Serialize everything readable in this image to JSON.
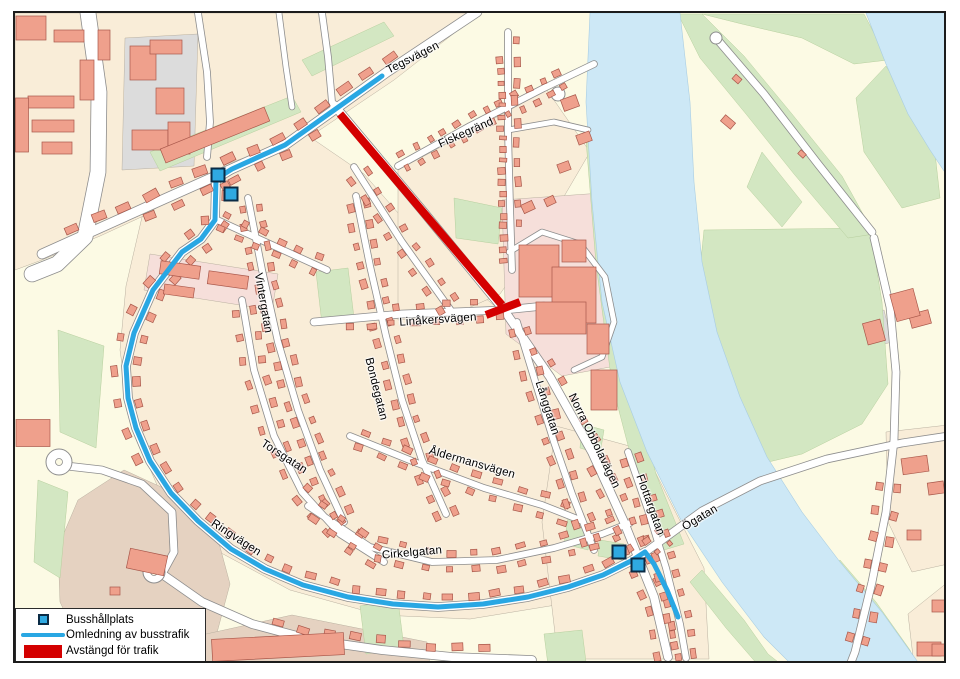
{
  "colors": {
    "route_blue": "#29A7E3",
    "closed_red": "#D40000",
    "bus_stop_fill": "#2FA9E1",
    "bus_stop_border": "#0A2B45",
    "water": "#CDE8F6",
    "green": "#D3E7C2",
    "building": "#EFA08C",
    "road": "#FFFFFF"
  },
  "legend": {
    "items": [
      {
        "id": "bus-stop",
        "symbol": "square",
        "label": "Busshållplats"
      },
      {
        "id": "detour",
        "symbol": "line",
        "label": "Omledning av busstrafik"
      },
      {
        "id": "closed",
        "symbol": "rect",
        "label": "Avstängd för trafik"
      }
    ]
  },
  "map": {
    "street_labels": [
      {
        "id": "tegsvagen",
        "text": "Tegsvägen",
        "x": 411,
        "y": 56,
        "rot": -27
      },
      {
        "id": "fiskegrand",
        "text": "Fiskegränd",
        "x": 464,
        "y": 131,
        "rot": -24
      },
      {
        "id": "vintergatan",
        "text": "Vintergatan",
        "x": 261,
        "y": 301,
        "rot": 80
      },
      {
        "id": "linakersvagen",
        "text": "Linåkersvägen",
        "x": 436,
        "y": 318,
        "rot": -4
      },
      {
        "id": "bondegatan",
        "text": "Bondegatan",
        "x": 374,
        "y": 387,
        "rot": 76
      },
      {
        "id": "torsgatan",
        "text": "Torsgatan",
        "x": 282,
        "y": 455,
        "rot": 33
      },
      {
        "id": "aldermansvagen",
        "text": "Åldermansvägen",
        "x": 470,
        "y": 461,
        "rot": 16
      },
      {
        "id": "cirkelgatan",
        "text": "Cirkelgatan",
        "x": 410,
        "y": 551,
        "rot": -5
      },
      {
        "id": "ringvagen",
        "text": "Ringvägen",
        "x": 234,
        "y": 536,
        "rot": 33
      },
      {
        "id": "langgatan",
        "text": "Långgatan",
        "x": 545,
        "y": 406,
        "rot": 72
      },
      {
        "id": "norra-obbolavagen",
        "text": "Norra Obbolavägen",
        "x": 592,
        "y": 439,
        "rot": 64
      },
      {
        "id": "flottargatan",
        "text": "Flottargatan",
        "x": 648,
        "y": 503,
        "rot": 70
      },
      {
        "id": "ogatan",
        "text": "Ögatan",
        "x": 698,
        "y": 516,
        "rot": -31
      }
    ],
    "bus_stops": [
      {
        "x": 216,
        "y": 173
      },
      {
        "x": 229,
        "y": 192
      },
      {
        "x": 617,
        "y": 550
      },
      {
        "x": 636,
        "y": 563
      }
    ],
    "detour_route": {
      "points": [
        [
          380,
          74
        ],
        [
          283,
          143
        ],
        [
          230,
          167
        ],
        [
          214,
          177
        ],
        [
          213,
          218
        ],
        [
          199,
          237
        ],
        [
          180,
          250
        ],
        [
          151,
          288
        ],
        [
          132,
          331
        ],
        [
          124,
          364
        ],
        [
          126,
          396
        ],
        [
          134,
          426
        ],
        [
          148,
          459
        ],
        [
          169,
          491
        ],
        [
          196,
          519
        ],
        [
          229,
          547
        ],
        [
          263,
          567
        ],
        [
          301,
          583
        ],
        [
          346,
          595
        ],
        [
          391,
          602
        ],
        [
          436,
          605
        ],
        [
          481,
          602
        ],
        [
          526,
          595
        ],
        [
          566,
          585
        ],
        [
          601,
          573
        ],
        [
          629,
          559
        ],
        [
          643,
          550
        ],
        [
          652,
          562
        ],
        [
          665,
          588
        ],
        [
          676,
          615
        ]
      ]
    },
    "closed_segment": {
      "line": [
        [
          338,
          112
        ],
        [
          500,
          303
        ]
      ],
      "cap": [
        [
          484,
          313
        ],
        [
          518,
          300
        ]
      ]
    }
  }
}
